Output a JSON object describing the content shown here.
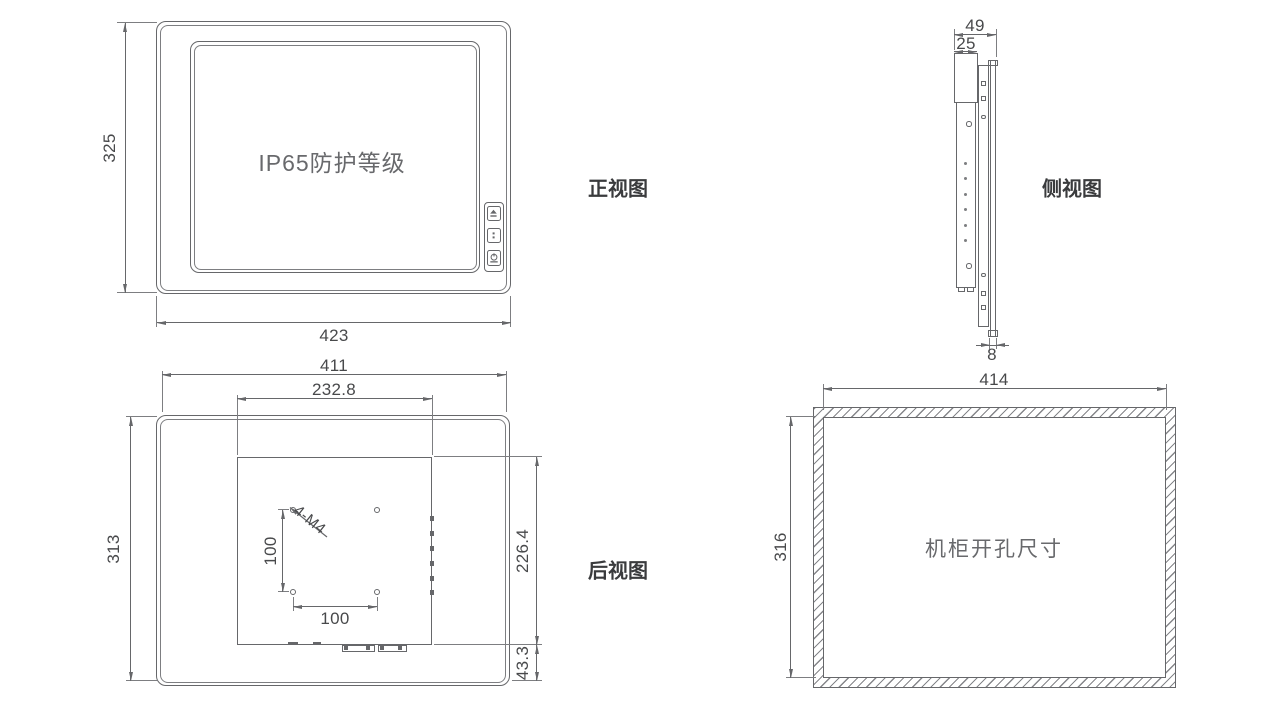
{
  "front": {
    "label": "正视图",
    "screen_text": "IP65防护等级",
    "dim_width": "423",
    "dim_height": "325",
    "buttons": [
      {
        "icon": "brightness-up-icon"
      },
      {
        "icon": "menu-dots-icon"
      },
      {
        "icon": "power-icon"
      }
    ]
  },
  "side": {
    "label": "侧视图",
    "dim_total_depth": "49",
    "dim_body_depth": "25",
    "dim_panel_thickness": "8"
  },
  "rear": {
    "label": "后视图",
    "dim_width": "411",
    "dim_module_width": "232.8",
    "dim_height": "313",
    "dim_module_height": "226.4",
    "dim_bottom_offset": "43.3",
    "dim_vesa_vertical": "100",
    "dim_vesa_horizontal": "100",
    "vesa_thread_label": "4-M4"
  },
  "cutout": {
    "title": "机柜开孔尺寸",
    "dim_width": "414",
    "dim_height": "316"
  }
}
